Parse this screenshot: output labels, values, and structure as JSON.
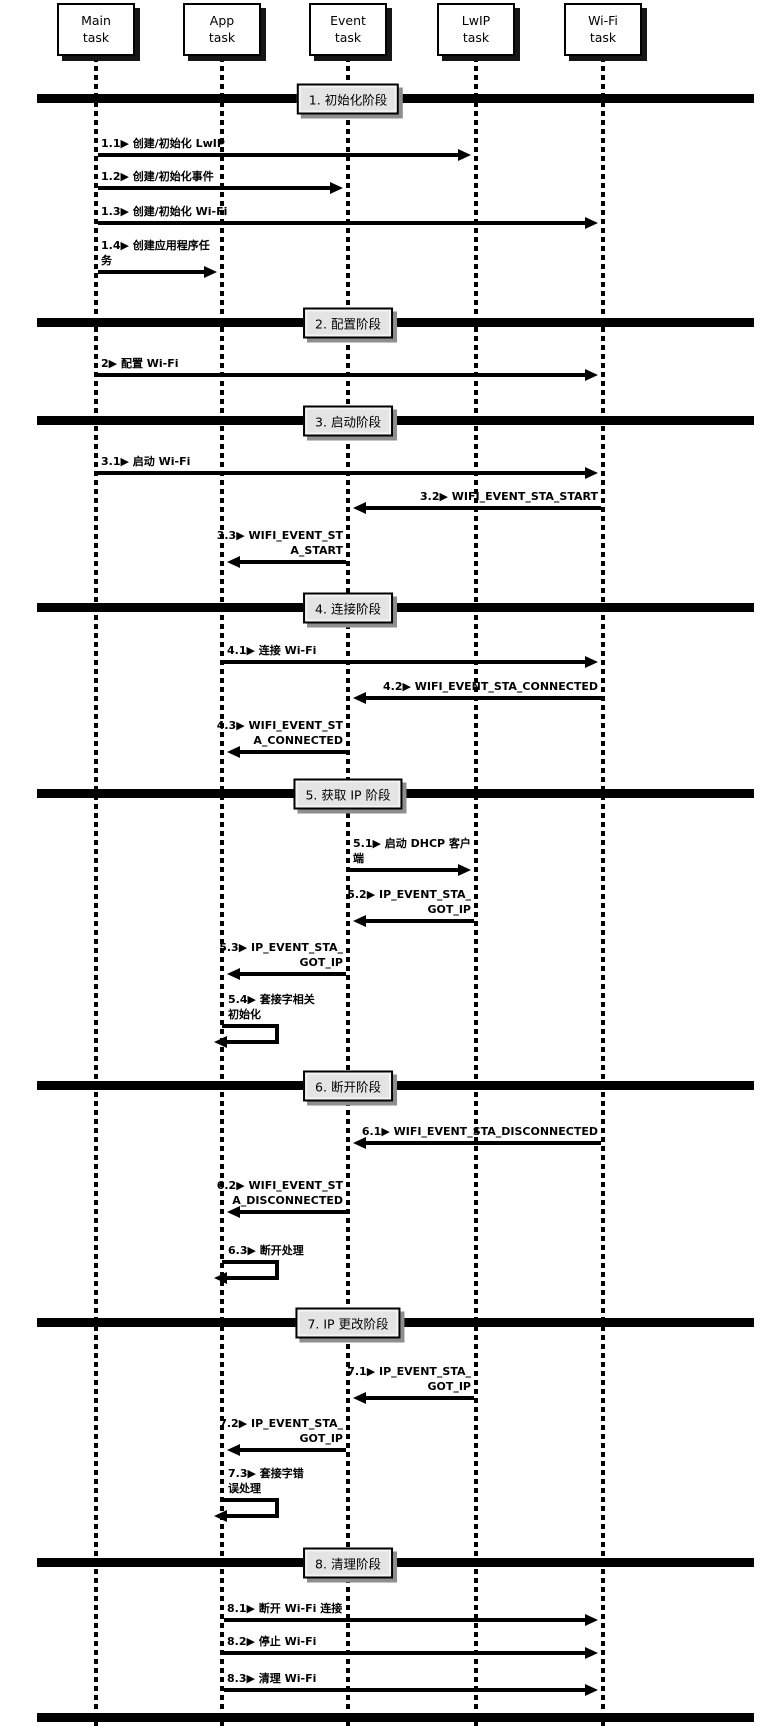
{
  "diagram": {
    "colors": {
      "line": "#000000",
      "task_box_bg": "#ffffff",
      "task_box_shadow": "#161616",
      "phase_box_bg": "#e4e4e4",
      "phase_box_shadow": "#8e8e8e"
    },
    "actors": [
      {
        "id": "main",
        "lines": [
          "Main",
          "task"
        ],
        "x": 96
      },
      {
        "id": "app",
        "lines": [
          "App",
          "task"
        ],
        "x": 222
      },
      {
        "id": "event",
        "lines": [
          "Event",
          "task"
        ],
        "x": 348
      },
      {
        "id": "lwip",
        "lines": [
          "LwIP",
          "task"
        ],
        "x": 476
      },
      {
        "id": "wifi",
        "lines": [
          "Wi-Fi",
          "task"
        ],
        "x": 603
      }
    ],
    "phases": [
      {
        "label": "1. 初始化阶段",
        "bar_y": 94,
        "messages": [
          {
            "lines": [
              "1.1▶ 创建/初始化 LwIP"
            ],
            "from": "main",
            "to": "lwip",
            "y": 155
          },
          {
            "lines": [
              "1.2▶ 创建/初始化事件"
            ],
            "from": "main",
            "to": "event",
            "y": 188
          },
          {
            "lines": [
              "1.3▶ 创建/初始化 Wi-Fi"
            ],
            "from": "main",
            "to": "wifi",
            "y": 223
          },
          {
            "lines": [
              "1.4▶ 创建应用程序任",
              "务"
            ],
            "from": "main",
            "to": "app",
            "y": 272
          }
        ]
      },
      {
        "label": "2. 配置阶段",
        "bar_y": 318,
        "messages": [
          {
            "lines": [
              "2▶ 配置 Wi-Fi"
            ],
            "from": "main",
            "to": "wifi",
            "y": 375
          }
        ]
      },
      {
        "label": "3. 启动阶段",
        "bar_y": 416,
        "messages": [
          {
            "lines": [
              "3.1▶ 启动 Wi-Fi"
            ],
            "from": "main",
            "to": "wifi",
            "y": 473
          },
          {
            "lines": [
              "3.2▶ WIFI_EVENT_STA_START"
            ],
            "from": "wifi",
            "to": "event",
            "y": 508
          },
          {
            "lines": [
              "3.3▶ WIFI_EVENT_ST",
              "A_START"
            ],
            "from": "event",
            "to": "app",
            "y": 562
          }
        ]
      },
      {
        "label": "4. 连接阶段",
        "bar_y": 603,
        "messages": [
          {
            "lines": [
              "4.1▶ 连接 Wi-Fi"
            ],
            "from": "app",
            "to": "wifi",
            "y": 662
          },
          {
            "lines": [
              "4.2▶ WIFI_EVENT_STA_CONNECTED"
            ],
            "from": "wifi",
            "to": "event",
            "y": 698
          },
          {
            "lines": [
              "4.3▶ WIFI_EVENT_ST",
              "A_CONNECTED"
            ],
            "from": "event",
            "to": "app",
            "y": 752
          }
        ]
      },
      {
        "label": "5. 获取 IP 阶段",
        "bar_y": 789,
        "messages": [
          {
            "lines": [
              "5.1▶ 启动 DHCP 客户",
              "端"
            ],
            "from": "event",
            "to": "lwip",
            "y": 870
          },
          {
            "lines": [
              "5.2▶ IP_EVENT_STA_",
              "GOT_IP"
            ],
            "from": "lwip",
            "to": "event",
            "y": 921
          },
          {
            "lines": [
              "5.3▶ IP_EVENT_STA_",
              "GOT_IP"
            ],
            "from": "event",
            "to": "app",
            "y": 974
          },
          {
            "lines": [
              "5.4▶ 套接字相关",
              "初始化"
            ],
            "self": "app",
            "y": 1026
          }
        ]
      },
      {
        "label": "6. 断开阶段",
        "bar_y": 1081,
        "messages": [
          {
            "lines": [
              "6.1▶ WIFI_EVENT_STA_DISCONNECTED"
            ],
            "from": "wifi",
            "to": "event",
            "y": 1143
          },
          {
            "lines": [
              "6.2▶ WIFI_EVENT_ST",
              "A_DISCONNECTED"
            ],
            "from": "event",
            "to": "app",
            "y": 1212
          },
          {
            "lines": [
              "6.3▶ 断开处理"
            ],
            "self": "app",
            "y": 1262
          }
        ]
      },
      {
        "label": "7. IP 更改阶段",
        "bar_y": 1318,
        "messages": [
          {
            "lines": [
              "7.1▶ IP_EVENT_STA_",
              "GOT_IP"
            ],
            "from": "lwip",
            "to": "event",
            "y": 1398
          },
          {
            "lines": [
              "7.2▶ IP_EVENT_STA_",
              "GOT_IP"
            ],
            "from": "event",
            "to": "app",
            "y": 1450
          },
          {
            "lines": [
              "7.3▶ 套接字错",
              "误处理"
            ],
            "self": "app",
            "y": 1500
          }
        ]
      },
      {
        "label": "8. 清理阶段",
        "bar_y": 1558,
        "messages": [
          {
            "lines": [
              "8.1▶ 断开 Wi-Fi 连接"
            ],
            "from": "app",
            "to": "wifi",
            "y": 1620
          },
          {
            "lines": [
              "8.2▶ 停止 Wi-Fi"
            ],
            "from": "app",
            "to": "wifi",
            "y": 1653
          },
          {
            "lines": [
              "8.3▶ 清理 Wi-Fi"
            ],
            "from": "app",
            "to": "wifi",
            "y": 1690
          }
        ]
      }
    ],
    "bottom_bar_y": 1713
  }
}
